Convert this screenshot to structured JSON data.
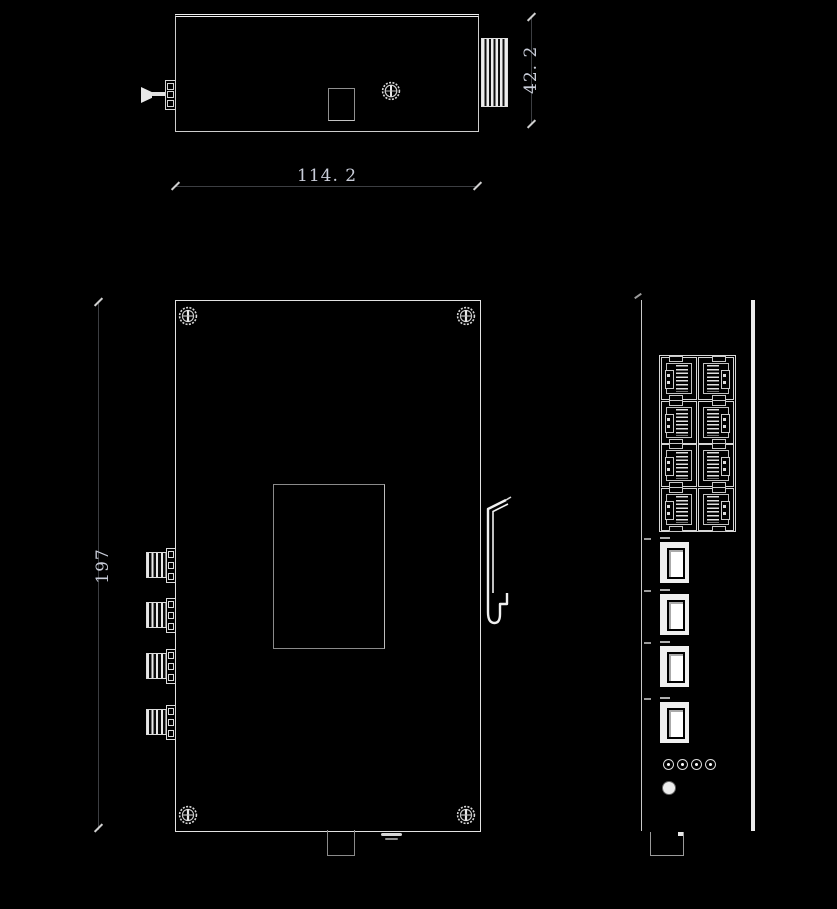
{
  "colors": {
    "background": "#000000",
    "outline": "#e2e2e2",
    "dim_line": "#3c3e42",
    "dim_text": "#c9cdd9"
  },
  "dimensions": {
    "top_width": "114. 2",
    "top_height": "42. 2",
    "front_height": "197"
  },
  "top_view": {
    "ground_screw": "ground-screw",
    "din_rail_block": "din-rail-block",
    "knurled_screw": "knurled-screw"
  },
  "front_view": {
    "corner_screw_count": 4,
    "terminal_count": 4,
    "din_clip": "din-rail-clip"
  },
  "side_view": {
    "rj45_rows": 4,
    "rj45_cols": 2,
    "fiber_slot_count": 4,
    "led_count": 4
  }
}
